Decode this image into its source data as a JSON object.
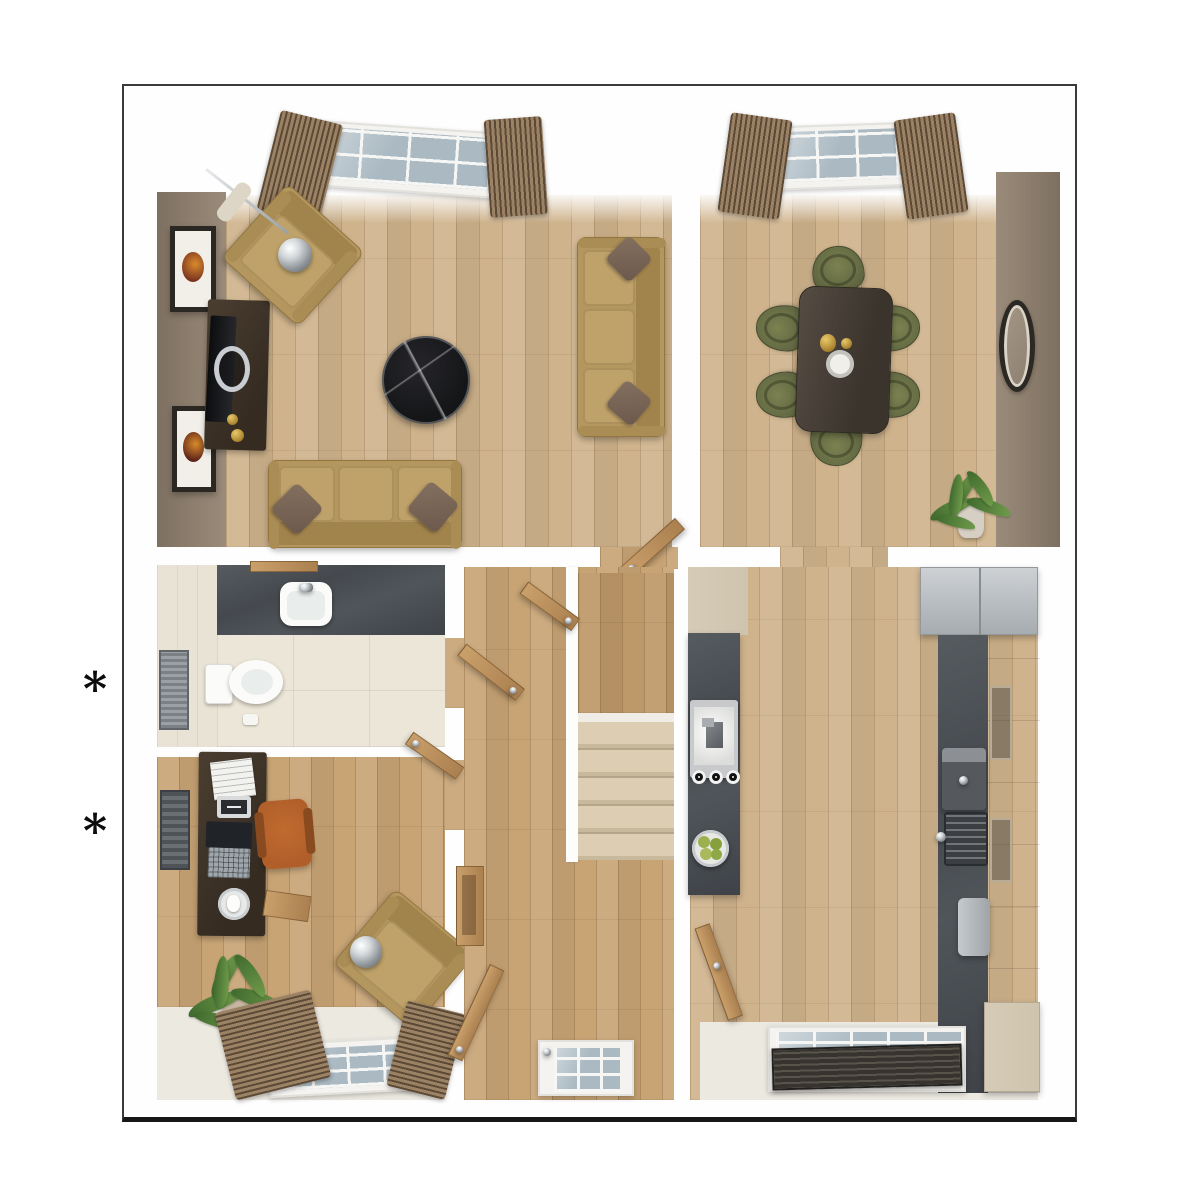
{
  "annotations": {
    "markers": [
      {
        "symbol": "*"
      },
      {
        "symbol": "*"
      }
    ]
  },
  "palette": {
    "floor_wood": "#cfb38c",
    "floor_warm": "#c8a475",
    "wall_taupe_1": "#7e7060",
    "wall_taupe_2": "#9a8b7a",
    "tile_floor": "#ece6d8",
    "counter_slate": "#4a4f54",
    "cabinet_cream": "#cfc4ae",
    "sofa_tan": "#b4965f",
    "chair_olive": "#5f6540",
    "chair_orange": "#b05e2a",
    "cushion": "#6d594c",
    "wood_dark": "#3f3329",
    "door_oak": "#bb9263",
    "carpet_stair": "#d8c8ab",
    "appliance_gray": "#bdc1c5",
    "curtain_dark": "#5d4a36",
    "curtain_light": "#9b8264",
    "glass": "#aab9c2",
    "plant_green": "#6f9a4a",
    "marble_black": "#141517"
  },
  "floorplan": {
    "view": "3d-top-down-ground-floor",
    "rooms": [
      {
        "name": "living-room",
        "contents": [
          "armchair",
          "arc-floor-lamp",
          "tv-unit",
          "television",
          "wall-art",
          "wall-art",
          "round-coffee-table",
          "sofa-three-seat",
          "sofa-three-seat",
          "throw-cushions",
          "french-windows",
          "curtains",
          "door"
        ]
      },
      {
        "name": "dining-room",
        "contents": [
          "dining-table",
          "dining-chair",
          "dining-chair",
          "dining-chair",
          "dining-chair",
          "dining-chair",
          "dining-chair",
          "wall-mirror",
          "potted-plant",
          "window",
          "curtains"
        ]
      },
      {
        "name": "wc",
        "contents": [
          "vanity-counter",
          "basin",
          "toilet",
          "towel-radiator",
          "tiled-floor"
        ]
      },
      {
        "name": "study",
        "contents": [
          "desk",
          "laptop",
          "papers",
          "office-chair",
          "armchair",
          "floor-lamp",
          "potted-plant",
          "radiator",
          "window",
          "curtains"
        ]
      },
      {
        "name": "hallway",
        "contents": [
          "staircase",
          "stair-landing",
          "console-shelf",
          "front-door",
          "door-leaf",
          "door-leaf"
        ]
      },
      {
        "name": "kitchen-breakfast",
        "contents": [
          "island-counter",
          "hob",
          "control-knobs",
          "fruit-bowl",
          "worktop",
          "sink",
          "coffee-machine",
          "toaster",
          "fridge-freezer",
          "tall-cabinet",
          "wall-cabinets",
          "window",
          "venetian-blind",
          "door-leaf"
        ]
      }
    ]
  }
}
